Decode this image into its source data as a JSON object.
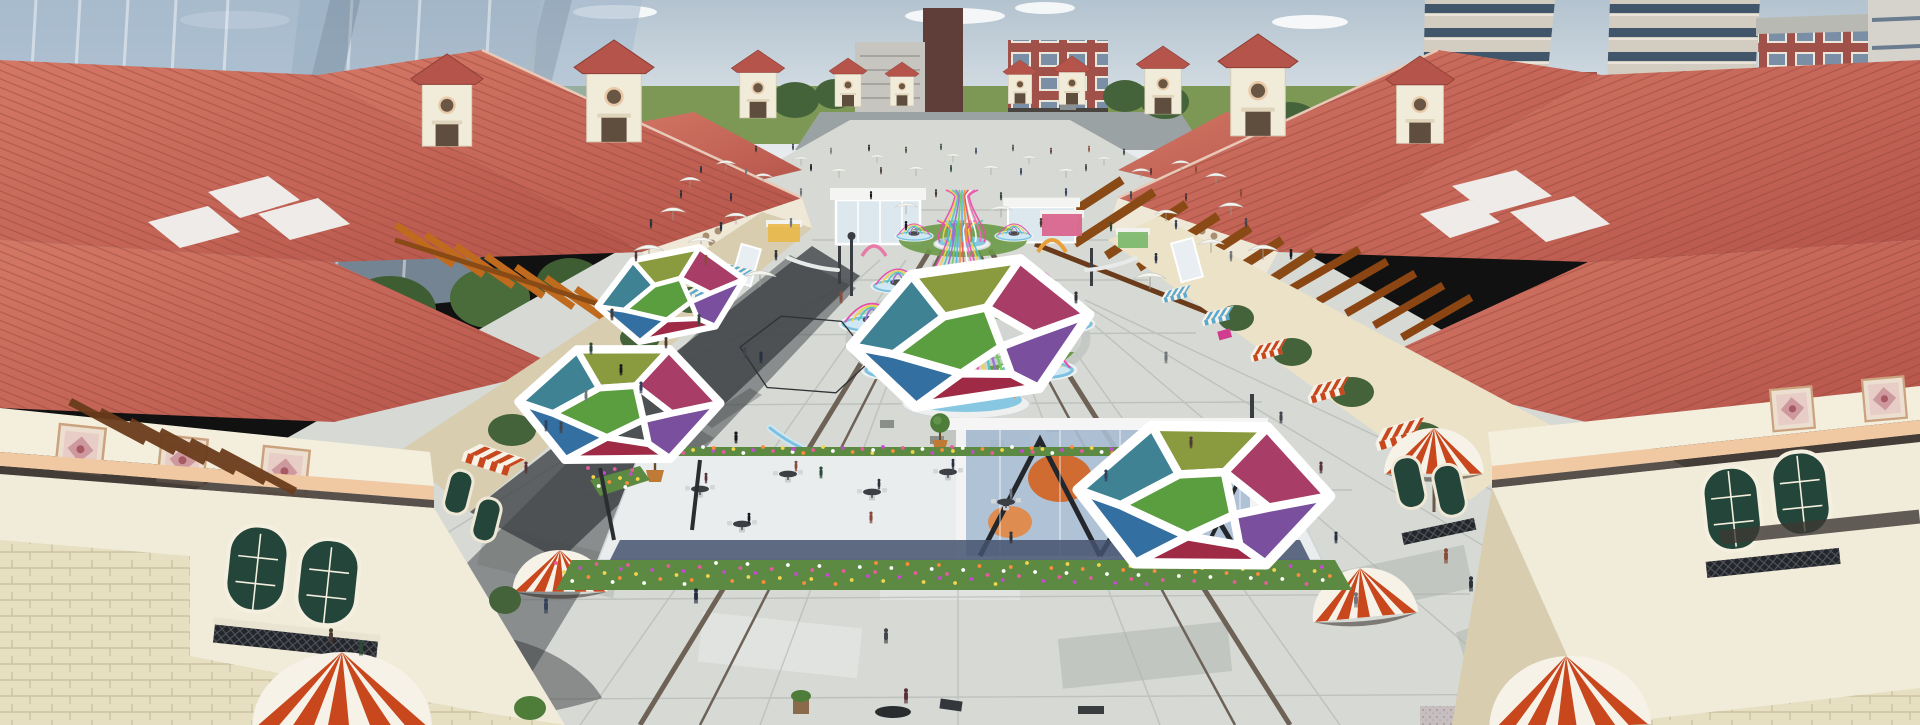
{
  "scene": {
    "description": "Aerial 3D architectural rendering of a Mediterranean-style open-air shopping plaza: symmetric red clay-tile roofed retail blocks with towers and pergolas flank a long grey-paved pedestrian mall filled with white parasols, colorful birdcage pavilions, stained-glass hexagonal canopies, striped awnings and pedestrians; modern city towers in the background",
    "render_style": "architectural-visualization",
    "visible_text": "none"
  },
  "palette": {
    "sky_top": "#b3c3cf",
    "sky_bottom": "#e9edf0",
    "horizon_green": "#7c9854",
    "road_grey": "#9ba2a4",
    "glass_tower": "#a4b8cc",
    "slab_grey": "#c6c5bf",
    "dark_tower": "#5f3d38",
    "brick": "#a0524a",
    "apartment_beige": "#d3cdc1",
    "window_band": "#41566b",
    "roof_red": "#b5544a",
    "roof_red_lit": "#d47866",
    "roof_line": "#8f3f35",
    "gable_cream": "#efe8d6",
    "wall_cream": "#f1ebda",
    "wall_shade": "#d9cdb0",
    "stone": "#e7dfc2",
    "stone_line": "#c9bd9c",
    "trim_peach": "#f0c8a2",
    "frieze_dark": "#4a413c",
    "pergola_orange": "#c06a1e",
    "pergola_brown": "#8a4a16",
    "pergola_dark": "#6b3c1c",
    "awning_red": "#c8471d",
    "awning_blue": "#5aa8cc",
    "awning_white": "#f6f2e8",
    "shutter_green": "#24453a",
    "paving_base": "#d6d9d4",
    "paving_light": "#e3e5e1",
    "paving_mid": "#bfc4bf",
    "paving_dark": "#a3a8a3",
    "paving_joint": "#aeb2ae",
    "guide_strip": "#6e6257",
    "shadow_dark": "#2c2f31",
    "walkway_shadow": "#3e4246",
    "grass": "#6b9947",
    "flower_bed_green": "#5d8a42",
    "water_blue": "#7cc2e0",
    "deck_white": "#e9edee",
    "deck_band_blue": "#45526e",
    "canopy_frame": "#ffffff",
    "glass_pavilion": "#a9bdd3",
    "art_orange": "#d4631f",
    "pot_terracotta": "#bf7a35",
    "tree_green": "#45633a",
    "tree_light": "#4e7d3a",
    "granite": "#c7bec0",
    "sign_pink": "#d23c8e"
  },
  "canopy_panels": [
    "#3e8294",
    "#8a9a3e",
    "#a83d68",
    "#5a9e3f",
    "#7a4f9e",
    "#9e2a46",
    "#336fa0"
  ],
  "ribbon_colors": [
    "#e84fa8",
    "#f2d24a",
    "#4ec8b8",
    "#9a6fd8",
    "#6ace5e",
    "#52b8e8",
    "#f0923a",
    "#e85a5a",
    "#ffffff",
    "#f06eb8"
  ],
  "people_colors": [
    "#2d3338",
    "#41454c",
    "#4a3c34",
    "#263040",
    "#58323a",
    "#2f4a38",
    "#70757c",
    "#8a4a3a",
    "#33415c",
    "#15181c"
  ],
  "flower_colors": [
    "#e85a9e",
    "#f3d44e",
    "#ffffff",
    "#c44ad0",
    "#ff8c3a"
  ],
  "cages": [
    {
      "cx": 966,
      "yTop": 292,
      "yBase": 398,
      "tw": 14,
      "ww": 26,
      "bw": 52,
      "n": 16
    },
    {
      "cx": 960,
      "yTop": 230,
      "yBase": 304,
      "tw": 10,
      "ww": 17,
      "bw": 36,
      "n": 12
    },
    {
      "cx": 962,
      "yTop": 196,
      "yBase": 242,
      "tw": 7,
      "ww": 11,
      "bw": 24,
      "n": 10
    }
  ],
  "umbrellas": [
    [
      690,
      180,
      0.55
    ],
    [
      726,
      163,
      0.5
    ],
    [
      763,
      176,
      0.5
    ],
    [
      801,
      159,
      0.45
    ],
    [
      839,
      171,
      0.5
    ],
    [
      877,
      157,
      0.45
    ],
    [
      916,
      169,
      0.5
    ],
    [
      953,
      156,
      0.45
    ],
    [
      991,
      168,
      0.5
    ],
    [
      1029,
      158,
      0.45
    ],
    [
      1066,
      171,
      0.5
    ],
    [
      1104,
      159,
      0.45
    ],
    [
      1141,
      171,
      0.5
    ],
    [
      1181,
      163,
      0.5
    ],
    [
      1216,
      176,
      0.55
    ],
    [
      673,
      211,
      0.65
    ],
    [
      736,
      216,
      0.6
    ],
    [
      906,
      206,
      0.6
    ],
    [
      1001,
      209,
      0.6
    ],
    [
      1166,
      213,
      0.6
    ],
    [
      1231,
      206,
      0.65
    ],
    [
      649,
      249,
      0.78
    ],
    [
      1263,
      249,
      0.78
    ],
    [
      701,
      241,
      0.7
    ],
    [
      1211,
      243,
      0.7
    ],
    [
      760,
      275,
      0.85
    ],
    [
      1150,
      277,
      0.85
    ]
  ],
  "people": [
    [
      756,
      152,
      0.5
    ],
    [
      793,
      150,
      0.5
    ],
    [
      831,
      154,
      0.5
    ],
    [
      869,
      151,
      0.5
    ],
    [
      906,
      153,
      0.5
    ],
    [
      941,
      150,
      0.5
    ],
    [
      976,
      154,
      0.5
    ],
    [
      1013,
      151,
      0.5
    ],
    [
      1051,
      154,
      0.5
    ],
    [
      1089,
      152,
      0.5
    ],
    [
      1124,
      155,
      0.5
    ],
    [
      701,
      173,
      0.55
    ],
    [
      746,
      175,
      0.55
    ],
    [
      811,
      171,
      0.55
    ],
    [
      881,
      174,
      0.55
    ],
    [
      951,
      172,
      0.55
    ],
    [
      1021,
      175,
      0.55
    ],
    [
      1086,
      171,
      0.55
    ],
    [
      1151,
      175,
      0.55
    ],
    [
      1196,
      173,
      0.55
    ],
    [
      681,
      198,
      0.62
    ],
    [
      731,
      201,
      0.62
    ],
    [
      801,
      196,
      0.62
    ],
    [
      871,
      199,
      0.62
    ],
    [
      936,
      197,
      0.62
    ],
    [
      1001,
      200,
      0.62
    ],
    [
      1066,
      196,
      0.62
    ],
    [
      1131,
      199,
      0.62
    ],
    [
      1186,
      201,
      0.62
    ],
    [
      1241,
      197,
      0.62
    ],
    [
      651,
      228,
      0.7
    ],
    [
      721,
      231,
      0.7
    ],
    [
      791,
      227,
      0.7
    ],
    [
      906,
      230,
      0.7
    ],
    [
      1041,
      227,
      0.7
    ],
    [
      1111,
      231,
      0.7
    ],
    [
      1176,
      229,
      0.7
    ],
    [
      1246,
      227,
      0.7
    ],
    [
      636,
      261,
      0.78
    ],
    [
      706,
      265,
      0.78
    ],
    [
      776,
      260,
      0.78
    ],
    [
      1156,
      263,
      0.78
    ],
    [
      1231,
      261,
      0.78
    ],
    [
      1291,
      259,
      0.78
    ],
    [
      612,
      320,
      0.9
    ],
    [
      591,
      354,
      0.9
    ],
    [
      641,
      393,
      0.9
    ],
    [
      561,
      433,
      0.9
    ],
    [
      526,
      473,
      0.9
    ],
    [
      841,
      303,
      0.9
    ],
    [
      1076,
      303,
      0.9
    ],
    [
      761,
      363,
      0.9
    ],
    [
      1166,
      363,
      0.9
    ],
    [
      736,
      443,
      0.9
    ],
    [
      1191,
      448,
      0.9
    ],
    [
      821,
      478,
      0.9
    ],
    [
      1106,
      481,
      0.9
    ],
    [
      1281,
      423,
      0.9
    ],
    [
      1321,
      473,
      0.9
    ],
    [
      871,
      523,
      0.9
    ],
    [
      1011,
      543,
      0.9
    ],
    [
      1336,
      543,
      0.9
    ],
    [
      586,
      401,
      0.85
    ],
    [
      621,
      375,
      0.85
    ],
    [
      666,
      348,
      0.85
    ],
    [
      699,
      325,
      0.85
    ],
    [
      546,
      431,
      0.85
    ],
    [
      745,
      358,
      0.85
    ],
    [
      706,
      483,
      0.8
    ],
    [
      796,
      471,
      0.8
    ],
    [
      879,
      489,
      0.8
    ],
    [
      953,
      469,
      0.8
    ],
    [
      1011,
      499,
      0.8
    ],
    [
      749,
      523,
      0.8
    ],
    [
      331,
      643,
      1.15
    ],
    [
      361,
      655,
      1.15
    ],
    [
      546,
      613,
      1.15
    ],
    [
      886,
      643,
      1.15
    ],
    [
      906,
      703,
      1.15
    ],
    [
      1446,
      563,
      1.15
    ],
    [
      1471,
      591,
      1.15
    ],
    [
      696,
      603,
      1.15
    ],
    [
      1356,
      607,
      1.15
    ]
  ],
  "flower_beds": [
    {
      "x": 560,
      "y": 563,
      "w": 780,
      "h": 22,
      "n": 110
    },
    {
      "x": 638,
      "y": 447,
      "w": 620,
      "h": 7,
      "n": 70
    },
    {
      "x": 592,
      "y": 468,
      "w": 52,
      "h": 22,
      "n": 12
    }
  ]
}
